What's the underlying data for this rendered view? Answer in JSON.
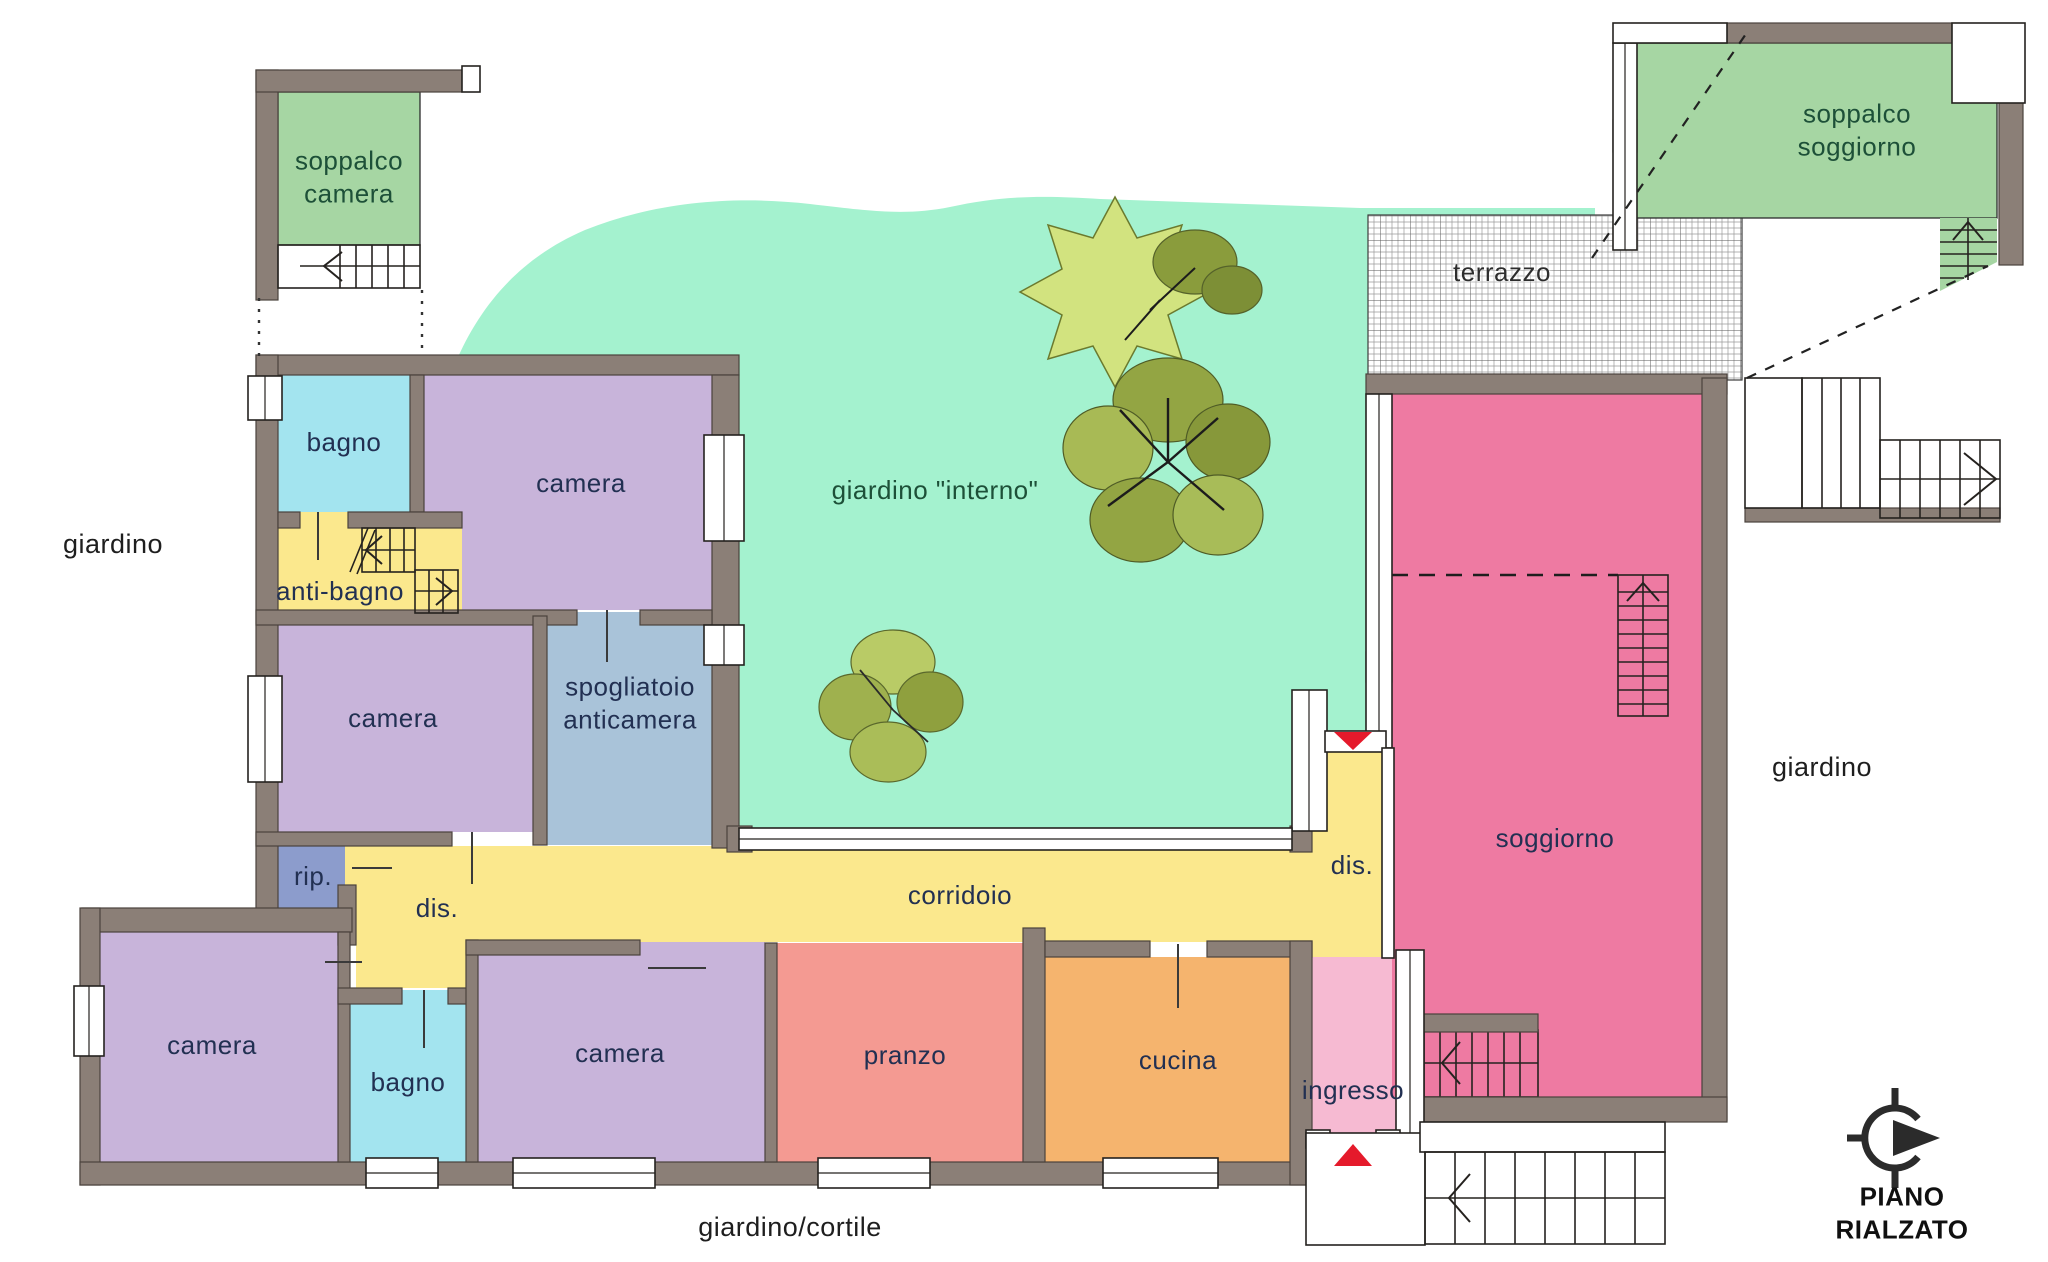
{
  "floor_plan": {
    "title": "PIANO RIALZATO",
    "palette": {
      "wall_grey": "#8b7f77",
      "inner_garden_green": "#a4f2cf",
      "soppalco_green": "#a6d6a3",
      "bathroom_cyan": "#a3e4ef",
      "bedroom_lavender": "#c8b4da",
      "service_yellow": "#fbe88d",
      "dressing_blue": "#a9c3d9",
      "storage_blue": "#8c9ccc",
      "dining_salmon": "#f49a92",
      "kitchen_orange": "#f5b46e",
      "entry_pink": "#f6bad2",
      "living_pink": "#ee7aa2",
      "arrow_red": "#e51a2b"
    },
    "outdoor": {
      "garden_left": "giardino",
      "garden_right": "giardino",
      "garden_courtyard": "giardino/cortile",
      "inner_garden": "giardino \"interno\"",
      "terrace": "terrazzo"
    },
    "rooms": {
      "soppalco_camera": "soppalco\ncamera",
      "soppalco_soggiorno": "soppalco\nsoggiorno",
      "bagno_nord": "bagno",
      "camera_nord": "camera",
      "anti_bagno": "anti-bagno",
      "camera_ovest": "camera",
      "spogliatoio": "spogliatoio\nanticamera",
      "ripostiglio": "rip.",
      "disimpegno_ovest": "dis.",
      "corridoio": "corridoio",
      "camera_sud_ovest": "camera",
      "bagno_sud": "bagno",
      "camera_sud": "camera",
      "pranzo": "pranzo",
      "cucina": "cucina",
      "disimpegno_est": "dis.",
      "ingresso": "ingresso",
      "soggiorno": "soggiorno"
    }
  }
}
